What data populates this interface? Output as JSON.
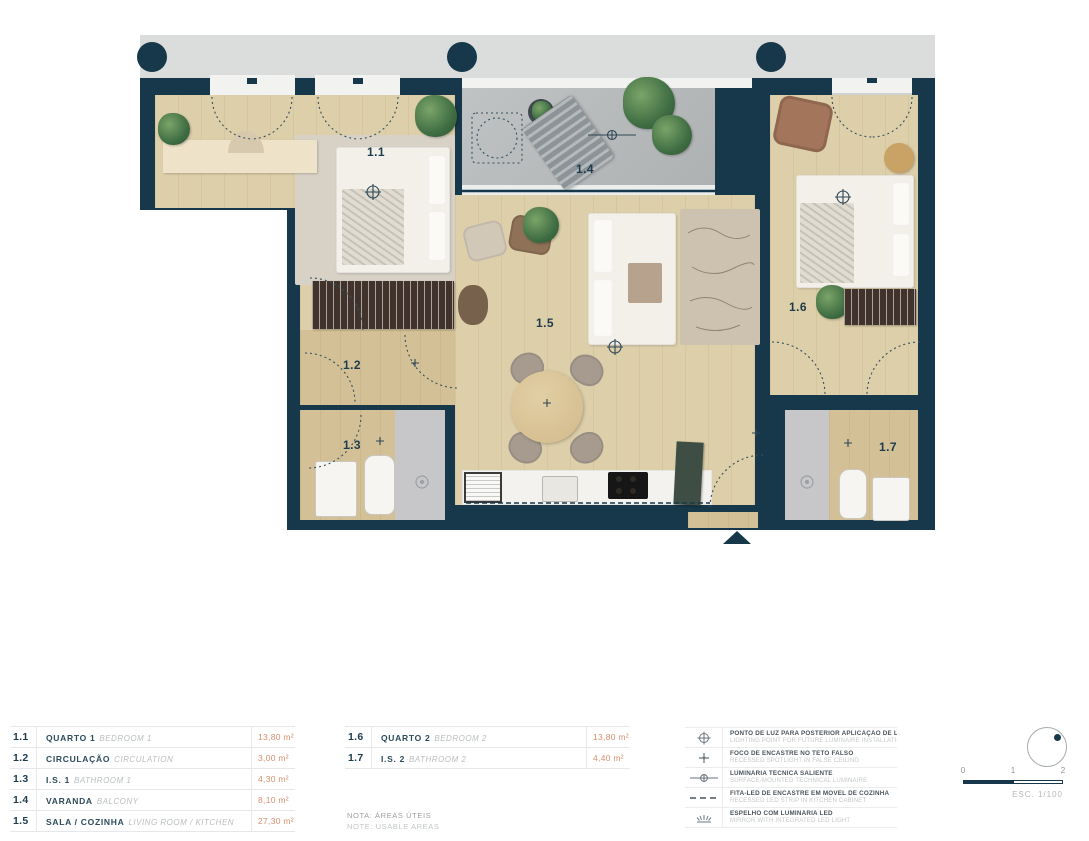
{
  "plan": {
    "room_labels": {
      "r11": "1.1",
      "r12": "1.2",
      "r13": "1.3",
      "r14": "1.4",
      "r15": "1.5",
      "r16": "1.6",
      "r17": "1.7"
    }
  },
  "tables": {
    "left": [
      {
        "num": "1.1",
        "pt": "QUARTO 1",
        "en": "BEDROOM 1",
        "area": "13,80 m²"
      },
      {
        "num": "1.2",
        "pt": "CIRCULAÇÃO",
        "en": "CIRCULATION",
        "area": "3,00 m²"
      },
      {
        "num": "1.3",
        "pt": "I.S. 1",
        "en": "BATHROOM 1",
        "area": "4,30 m²"
      },
      {
        "num": "1.4",
        "pt": "VARANDA",
        "en": "BALCONY",
        "area": "8,10 m²"
      },
      {
        "num": "1.5",
        "pt": "SALA / COZINHA",
        "en": "LIVING ROOM / KITCHEN",
        "area": "27,30 m²"
      }
    ],
    "right": [
      {
        "num": "1.6",
        "pt": "QUARTO 2",
        "en": "BEDROOM 2",
        "area": "13,80 m²"
      },
      {
        "num": "1.7",
        "pt": "I.S. 2",
        "en": "BATHROOM 2",
        "area": "4,40 m²"
      }
    ]
  },
  "notes": {
    "pt": "NOTA: ÁREAS ÚTEIS",
    "en": "NOTE: USABLE AREAS"
  },
  "legend": [
    {
      "pt": "PONTO DE LUZ PARA POSTERIOR APLICAÇÃO DE LUMINÁRIA",
      "en": "LIGHTING POINT FOR FUTURE LUMINAIRE INSTALLATION"
    },
    {
      "pt": "FOCO DE ENCASTRE NO TETO FALSO",
      "en": "RECESSED SPOTLIGHT IN FALSE CEILING"
    },
    {
      "pt": "LUMINÁRIA TÉCNICA SALIENTE",
      "en": "SURFACE-MOUNTED TECHNICAL LUMINAIRE"
    },
    {
      "pt": "FITA-LED DE ENCASTRE EM MÓVEL DE COZINHA",
      "en": "RECESSED LED STRIP IN KITCHEN CABINET"
    },
    {
      "pt": "ESPELHO COM LUMINÁRIA LED",
      "en": "MIRROR WITH INTEGRATED LED LIGHT"
    }
  ],
  "scale": {
    "t0": "0",
    "t1": "1",
    "t2": "2",
    "caption": "ESC. 1/100"
  },
  "colors": {
    "wall": "#16384a",
    "area_accent": "#d98e6e",
    "balcony_floor": "#b9bcbd",
    "wood_floor": "#ddcfa9"
  }
}
